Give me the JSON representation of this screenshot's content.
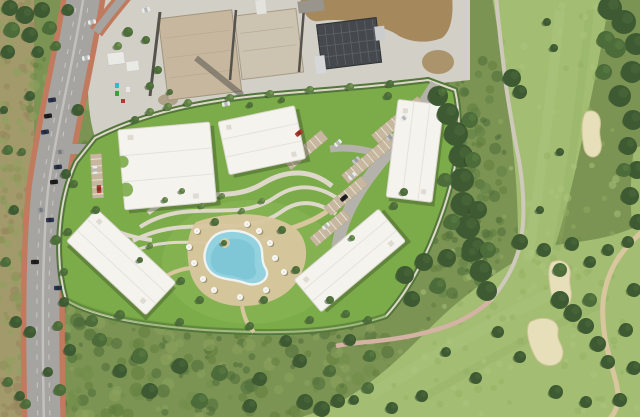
{
  "meta": {
    "description": "Aerial 3D composite photo: landscaped apartment development with five white-roofed buildings and an organic pool, beside a dual-carriageway road (left), an industrial construction lot (top) and a golf course with sand bunkers (right).",
    "image_type": "aerial-photograph",
    "text_visible": ""
  },
  "palette": {
    "scrubBase": "#7c9453",
    "scrubDark": "#5f7c3c",
    "scrubMid": "#6f8c48",
    "scrubLight": "#8ca35e",
    "dryStrip": "#a39a6b",
    "dryGreen": "#8a9156",
    "dryBrown": "#96855c",
    "fairway": "#a3bd72",
    "fairwayLight": "#aec781",
    "fairwayDark": "#93b062",
    "treeDark": "#3d5a32",
    "treeMid": "#4c6c3a",
    "treeLight": "#5e8045",
    "treeShadow": "#2c4224",
    "treeHi": "#85a45c",
    "lawn": "#7cab49",
    "lawnLight": "#8dbb5b",
    "lawnDark": "#6a9a3e",
    "hedge": "#53763a",
    "bldgWhite": "#f4f3ee",
    "bldgEdge": "#d9d6cc",
    "bldgShadow": "rgba(45,62,35,0.35)",
    "path": "#ded8ca",
    "pathSand": "#d8c69e",
    "pathPink": "#d4b3a4",
    "pool": "#92d1de",
    "poolDeep": "#6fbdd0",
    "poolRim": "#eef3f2",
    "roadAsphalt": "#a5a4a1",
    "sidewalk": "#c17a5e",
    "median": "#c2c1bd",
    "laneLine": "#d8d7d3",
    "roadLight": "#b5b2ac",
    "gravel": "#d2cfc7",
    "gravelShadow": "#aaa69a",
    "concretePad": "#c6b79e",
    "concretePad2": "#cdc3b1",
    "wall": "#55534b",
    "dirt": "#a5885c",
    "dirtDark": "#8c714a",
    "darkRoof": "#45494d",
    "solarLine": "#5d6368",
    "shed": "#e9e9e5",
    "bunker": "#e7dfba",
    "bunkerEdge": "#cfc598",
    "carNavy": "#2d3650",
    "carBlack": "#212124",
    "carGray": "#9a9c9e",
    "carWhite": "#ebecec",
    "carRed": "#b23a2e",
    "carSilver": "#c6c8c9"
  },
  "scene": {
    "trees": [
      [
        438,
        96,
        10,
        "d"
      ],
      [
        448,
        114,
        11,
        "d"
      ],
      [
        456,
        134,
        12,
        "d"
      ],
      [
        461,
        156,
        12,
        "d"
      ],
      [
        462,
        180,
        12,
        "d"
      ],
      [
        463,
        204,
        12,
        "d"
      ],
      [
        468,
        227,
        12,
        "d"
      ],
      [
        474,
        249,
        12,
        "d"
      ],
      [
        481,
        271,
        11,
        "d"
      ],
      [
        487,
        291,
        10,
        "d"
      ],
      [
        470,
        120,
        8,
        "m"
      ],
      [
        473,
        160,
        8,
        "m"
      ],
      [
        452,
        222,
        8,
        "m"
      ],
      [
        478,
        210,
        9,
        "d"
      ],
      [
        488,
        250,
        8,
        "m"
      ],
      [
        445,
        180,
        7,
        "m"
      ],
      [
        512,
        78,
        9,
        "d"
      ],
      [
        520,
        92,
        7,
        "d"
      ],
      [
        610,
        8,
        12,
        "d"
      ],
      [
        624,
        22,
        12,
        "d"
      ],
      [
        636,
        44,
        11,
        "d"
      ],
      [
        616,
        48,
        10,
        "m"
      ],
      [
        632,
        72,
        11,
        "d"
      ],
      [
        620,
        96,
        11,
        "d"
      ],
      [
        633,
        120,
        10,
        "d"
      ],
      [
        606,
        40,
        9,
        "m"
      ],
      [
        604,
        72,
        8,
        "m"
      ],
      [
        628,
        146,
        9,
        "d"
      ],
      [
        637,
        170,
        9,
        "d"
      ],
      [
        630,
        196,
        9,
        "d"
      ],
      [
        638,
        222,
        8,
        "d"
      ],
      [
        624,
        170,
        7,
        "m"
      ],
      [
        547,
        22,
        4,
        "d"
      ],
      [
        554,
        48,
        4,
        "d"
      ],
      [
        560,
        152,
        4,
        "d"
      ],
      [
        540,
        210,
        4,
        "d"
      ],
      [
        405,
        275,
        9,
        "d"
      ],
      [
        424,
        262,
        9,
        "d"
      ],
      [
        447,
        258,
        9,
        "d"
      ],
      [
        470,
        254,
        8,
        "d"
      ],
      [
        438,
        286,
        8,
        "m"
      ],
      [
        412,
        299,
        8,
        "d"
      ],
      [
        520,
        242,
        8,
        "d"
      ],
      [
        544,
        250,
        7,
        "d"
      ],
      [
        572,
        244,
        7,
        "d"
      ],
      [
        560,
        270,
        7,
        "m"
      ],
      [
        590,
        262,
        6,
        "d"
      ],
      [
        608,
        250,
        6,
        "d"
      ],
      [
        628,
        242,
        6,
        "d"
      ],
      [
        560,
        300,
        9,
        "d"
      ],
      [
        573,
        313,
        9,
        "d"
      ],
      [
        586,
        326,
        8,
        "d"
      ],
      [
        598,
        344,
        8,
        "d"
      ],
      [
        608,
        362,
        7,
        "d"
      ],
      [
        590,
        300,
        7,
        "m"
      ],
      [
        498,
        332,
        6,
        "d"
      ],
      [
        520,
        357,
        6,
        "d"
      ],
      [
        556,
        392,
        7,
        "d"
      ],
      [
        586,
        402,
        6,
        "d"
      ],
      [
        446,
        352,
        5,
        "d"
      ],
      [
        476,
        378,
        6,
        "d"
      ],
      [
        422,
        396,
        6,
        "d"
      ],
      [
        392,
        408,
        6,
        "d"
      ],
      [
        354,
        400,
        5,
        "d"
      ],
      [
        305,
        402,
        8,
        "d"
      ],
      [
        322,
        409,
        8,
        "d"
      ],
      [
        338,
        401,
        7,
        "d"
      ],
      [
        368,
        388,
        6,
        "m"
      ],
      [
        634,
        290,
        7,
        "d"
      ],
      [
        626,
        330,
        7,
        "d"
      ],
      [
        634,
        368,
        7,
        "d"
      ],
      [
        620,
        400,
        7,
        "d"
      ],
      [
        100,
        340,
        7,
        "m"
      ],
      [
        140,
        356,
        8,
        "m"
      ],
      [
        180,
        366,
        8,
        "d"
      ],
      [
        220,
        373,
        8,
        "m"
      ],
      [
        260,
        379,
        7,
        "d"
      ],
      [
        150,
        391,
        8,
        "d"
      ],
      [
        200,
        401,
        8,
        "m"
      ],
      [
        250,
        406,
        7,
        "d"
      ],
      [
        120,
        371,
        7,
        "d"
      ],
      [
        92,
        321,
        6,
        "m"
      ],
      [
        300,
        361,
        7,
        "d"
      ],
      [
        330,
        371,
        6,
        "m"
      ],
      [
        70,
        350,
        6,
        "d"
      ],
      [
        60,
        390,
        6,
        "m"
      ],
      [
        286,
        341,
        6,
        "d"
      ],
      [
        350,
        340,
        6,
        "d"
      ],
      [
        370,
        356,
        6,
        "m"
      ],
      [
        10,
        8,
        8,
        "d"
      ],
      [
        25,
        15,
        9,
        "d"
      ],
      [
        42,
        10,
        8,
        "d"
      ],
      [
        12,
        30,
        8,
        "m"
      ],
      [
        30,
        35,
        8,
        "d"
      ],
      [
        50,
        28,
        7,
        "m"
      ],
      [
        8,
        52,
        7,
        "d"
      ],
      [
        38,
        52,
        6,
        "d"
      ],
      [
        56,
        46,
        5,
        "m"
      ],
      [
        68,
        10,
        6,
        "d"
      ],
      [
        8,
        150,
        5,
        "m"
      ],
      [
        14,
        210,
        5,
        "d"
      ],
      [
        6,
        262,
        5,
        "m"
      ],
      [
        16,
        322,
        6,
        "d"
      ],
      [
        8,
        382,
        5,
        "m"
      ],
      [
        20,
        396,
        5,
        "d"
      ],
      [
        4,
        110,
        4,
        "d"
      ],
      [
        30,
        96,
        5,
        "d"
      ],
      [
        22,
        152,
        4,
        "m"
      ],
      [
        78,
        110,
        6,
        "d"
      ],
      [
        66,
        174,
        5,
        "d"
      ],
      [
        56,
        240,
        5,
        "m"
      ],
      [
        64,
        302,
        5,
        "d"
      ],
      [
        30,
        332,
        6,
        "d"
      ],
      [
        58,
        326,
        5,
        "m"
      ],
      [
        48,
        372,
        5,
        "d"
      ],
      [
        26,
        404,
        5,
        "m"
      ],
      [
        150,
        112,
        4,
        "l"
      ],
      [
        168,
        107,
        4,
        "l"
      ],
      [
        188,
        103,
        4,
        "l"
      ],
      [
        230,
        98,
        4,
        "l"
      ],
      [
        270,
        94,
        4,
        "l"
      ],
      [
        310,
        90,
        4,
        "l"
      ],
      [
        350,
        87,
        4,
        "l"
      ],
      [
        390,
        84,
        4,
        "m"
      ],
      [
        135,
        120,
        4,
        "m"
      ],
      [
        165,
        200,
        3,
        "l"
      ],
      [
        182,
        191,
        3,
        "l"
      ],
      [
        202,
        206,
        3,
        "l"
      ],
      [
        222,
        196,
        3,
        "l"
      ],
      [
        242,
        211,
        3,
        "l"
      ],
      [
        262,
        201,
        3,
        "l"
      ],
      [
        215,
        222,
        4,
        "m"
      ],
      [
        282,
        230,
        4,
        "m"
      ],
      [
        296,
        270,
        4,
        "m"
      ],
      [
        264,
        300,
        4,
        "m"
      ],
      [
        200,
        300,
        4,
        "m"
      ],
      [
        181,
        281,
        4,
        "m"
      ],
      [
        150,
        246,
        3,
        "l"
      ],
      [
        140,
        260,
        3,
        "m"
      ],
      [
        96,
        210,
        4,
        "m"
      ],
      [
        74,
        184,
        4,
        "m"
      ],
      [
        68,
        232,
        4,
        "m"
      ],
      [
        64,
        272,
        4,
        "m"
      ],
      [
        120,
        315,
        5,
        "m"
      ],
      [
        180,
        322,
        4,
        "m"
      ],
      [
        250,
        326,
        4,
        "m"
      ],
      [
        310,
        320,
        4,
        "m"
      ],
      [
        346,
        314,
        4,
        "m"
      ],
      [
        394,
        206,
        4,
        "m"
      ],
      [
        404,
        192,
        4,
        "m"
      ],
      [
        388,
        96,
        4,
        "m"
      ],
      [
        442,
        92,
        4,
        "m"
      ],
      [
        352,
        238,
        3,
        "l"
      ],
      [
        330,
        300,
        4,
        "m"
      ],
      [
        368,
        320,
        4,
        "m"
      ],
      [
        224,
        243,
        3,
        "m"
      ],
      [
        128,
        32,
        5,
        "m"
      ],
      [
        146,
        40,
        4,
        "m"
      ],
      [
        158,
        70,
        4,
        "m"
      ],
      [
        150,
        86,
        4,
        "m"
      ],
      [
        118,
        46,
        4,
        "l"
      ],
      [
        170,
        92,
        3,
        "m"
      ],
      [
        250,
        105,
        3,
        "m"
      ],
      [
        282,
        100,
        3,
        "m"
      ]
    ],
    "cars": [
      [
        52,
        100,
        -8,
        "carNavy"
      ],
      [
        48,
        116,
        -8,
        "carBlack"
      ],
      [
        45,
        132,
        -8,
        "carNavy"
      ],
      [
        60,
        152,
        -7,
        "carGray"
      ],
      [
        58,
        167,
        -6,
        "carNavy"
      ],
      [
        54,
        182,
        -6,
        "carBlack"
      ],
      [
        41,
        210,
        -4,
        "carGray"
      ],
      [
        50,
        220,
        -4,
        "carNavy"
      ],
      [
        35,
        262,
        -2,
        "carBlack"
      ],
      [
        58,
        288,
        -2,
        "carNavy"
      ],
      [
        92,
        22,
        -12,
        "carWhite"
      ],
      [
        86,
        58,
        -10,
        "carWhite"
      ],
      [
        146,
        10,
        -15,
        "carWhite"
      ],
      [
        226,
        104,
        -12,
        "carWhite"
      ],
      [
        299,
        133,
        -40,
        "carRed"
      ],
      [
        338,
        143,
        -40,
        "carWhite"
      ],
      [
        404,
        118,
        -40,
        "carWhite"
      ],
      [
        390,
        137,
        -40,
        "carSilver"
      ],
      [
        352,
        176,
        -40,
        "carWhite"
      ],
      [
        344,
        198,
        -40,
        "carBlack"
      ],
      [
        326,
        226,
        -40,
        "carWhite"
      ],
      [
        356,
        160,
        -40,
        "carSilver"
      ],
      [
        99,
        189,
        87,
        "carRed"
      ],
      [
        95,
        170,
        87,
        "carWhite"
      ]
    ],
    "umbrellas": [
      [
        197,
        231
      ],
      [
        189,
        247
      ],
      [
        194,
        263
      ],
      [
        247,
        224
      ],
      [
        259,
        231
      ],
      [
        270,
        243
      ],
      [
        275,
        258
      ],
      [
        266,
        290
      ],
      [
        240,
        297
      ],
      [
        214,
        290
      ],
      [
        203,
        279
      ],
      [
        284,
        272
      ]
    ],
    "bunkers": [
      {
        "d": "M586,112 C596,108 602,116 600,128 C598,138 604,144 600,152 C596,160 586,158 584,148 C582,138 580,120 586,112 Z"
      },
      {
        "d": "M552,262 C562,258 572,264 570,276 C568,286 574,292 570,302 C566,310 554,308 552,298 C550,288 546,268 552,262 Z"
      },
      {
        "d": "M530,322 C544,314 560,320 558,332 C556,342 566,346 562,358 C558,368 542,368 536,358 C530,348 524,330 530,322 Z"
      }
    ],
    "carports": [
      {
        "cx": 398,
        "cy": 120,
        "len": 60,
        "rot": -40
      },
      {
        "cx": 368,
        "cy": 160,
        "len": 60,
        "rot": -40
      },
      {
        "cx": 346,
        "cy": 196,
        "len": 48,
        "rot": -40
      },
      {
        "cx": 330,
        "cy": 228,
        "len": 44,
        "rot": -40
      },
      {
        "cx": 306,
        "cy": 150,
        "len": 48,
        "rot": -40
      },
      {
        "cx": 97,
        "cy": 176,
        "len": 44,
        "rot": 87
      }
    ],
    "texture_regions": [
      {
        "x": 0,
        "y": 0,
        "w": 34,
        "h": 417,
        "n": 170,
        "colors": [
          "dryGreen",
          "dryBrown",
          "scrubLight"
        ],
        "rmin": 2,
        "rmax": 5,
        "seed": 7,
        "layer": "under",
        "opacity": 0.55
      },
      {
        "x": 30,
        "y": 55,
        "w": 60,
        "h": 362,
        "n": 120,
        "colors": [
          "scrubDark",
          "scrubLight",
          "scrubMid"
        ],
        "rmin": 2,
        "rmax": 6,
        "seed": 11,
        "layer": "under",
        "opacity": 0.55
      },
      {
        "x": 60,
        "y": 318,
        "w": 330,
        "h": 99,
        "n": 230,
        "colors": [
          "scrubDark",
          "scrubLight",
          "scrubMid",
          "treeMid"
        ],
        "rmin": 2,
        "rmax": 7,
        "seed": 23,
        "layer": "under",
        "opacity": 0.55
      },
      {
        "x": 425,
        "y": 55,
        "w": 80,
        "h": 270,
        "n": 140,
        "colors": [
          "treeMid",
          "treeLight",
          "scrubDark"
        ],
        "rmin": 2,
        "rmax": 6,
        "seed": 31,
        "layer": "under",
        "opacity": 0.55
      },
      {
        "x": 480,
        "y": 230,
        "w": 160,
        "h": 100,
        "n": 60,
        "colors": [
          "treeLight",
          "scrubMid"
        ],
        "rmin": 2,
        "rmax": 5,
        "seed": 41,
        "layer": "under",
        "opacity": 0.5
      },
      {
        "x": 500,
        "y": 0,
        "w": 120,
        "h": 300,
        "n": 60,
        "colors": [
          "fairwayLight",
          "fairwayDark"
        ],
        "rmin": 2,
        "rmax": 4,
        "seed": 61,
        "layer": "golf",
        "opacity": 0.45
      },
      {
        "x": 380,
        "y": 250,
        "w": 260,
        "h": 167,
        "n": 90,
        "colors": [
          "fairwayLight",
          "fairwayDark"
        ],
        "rmin": 2,
        "rmax": 4,
        "seed": 71,
        "layer": "golf",
        "opacity": 0.45
      },
      {
        "x": 95,
        "y": 10,
        "w": 210,
        "h": 120,
        "n": 45,
        "colors": [
          "gravelShadow"
        ],
        "rmin": 1,
        "rmax": 3,
        "seed": 53,
        "layer": "under",
        "opacity": 0.3
      }
    ]
  }
}
